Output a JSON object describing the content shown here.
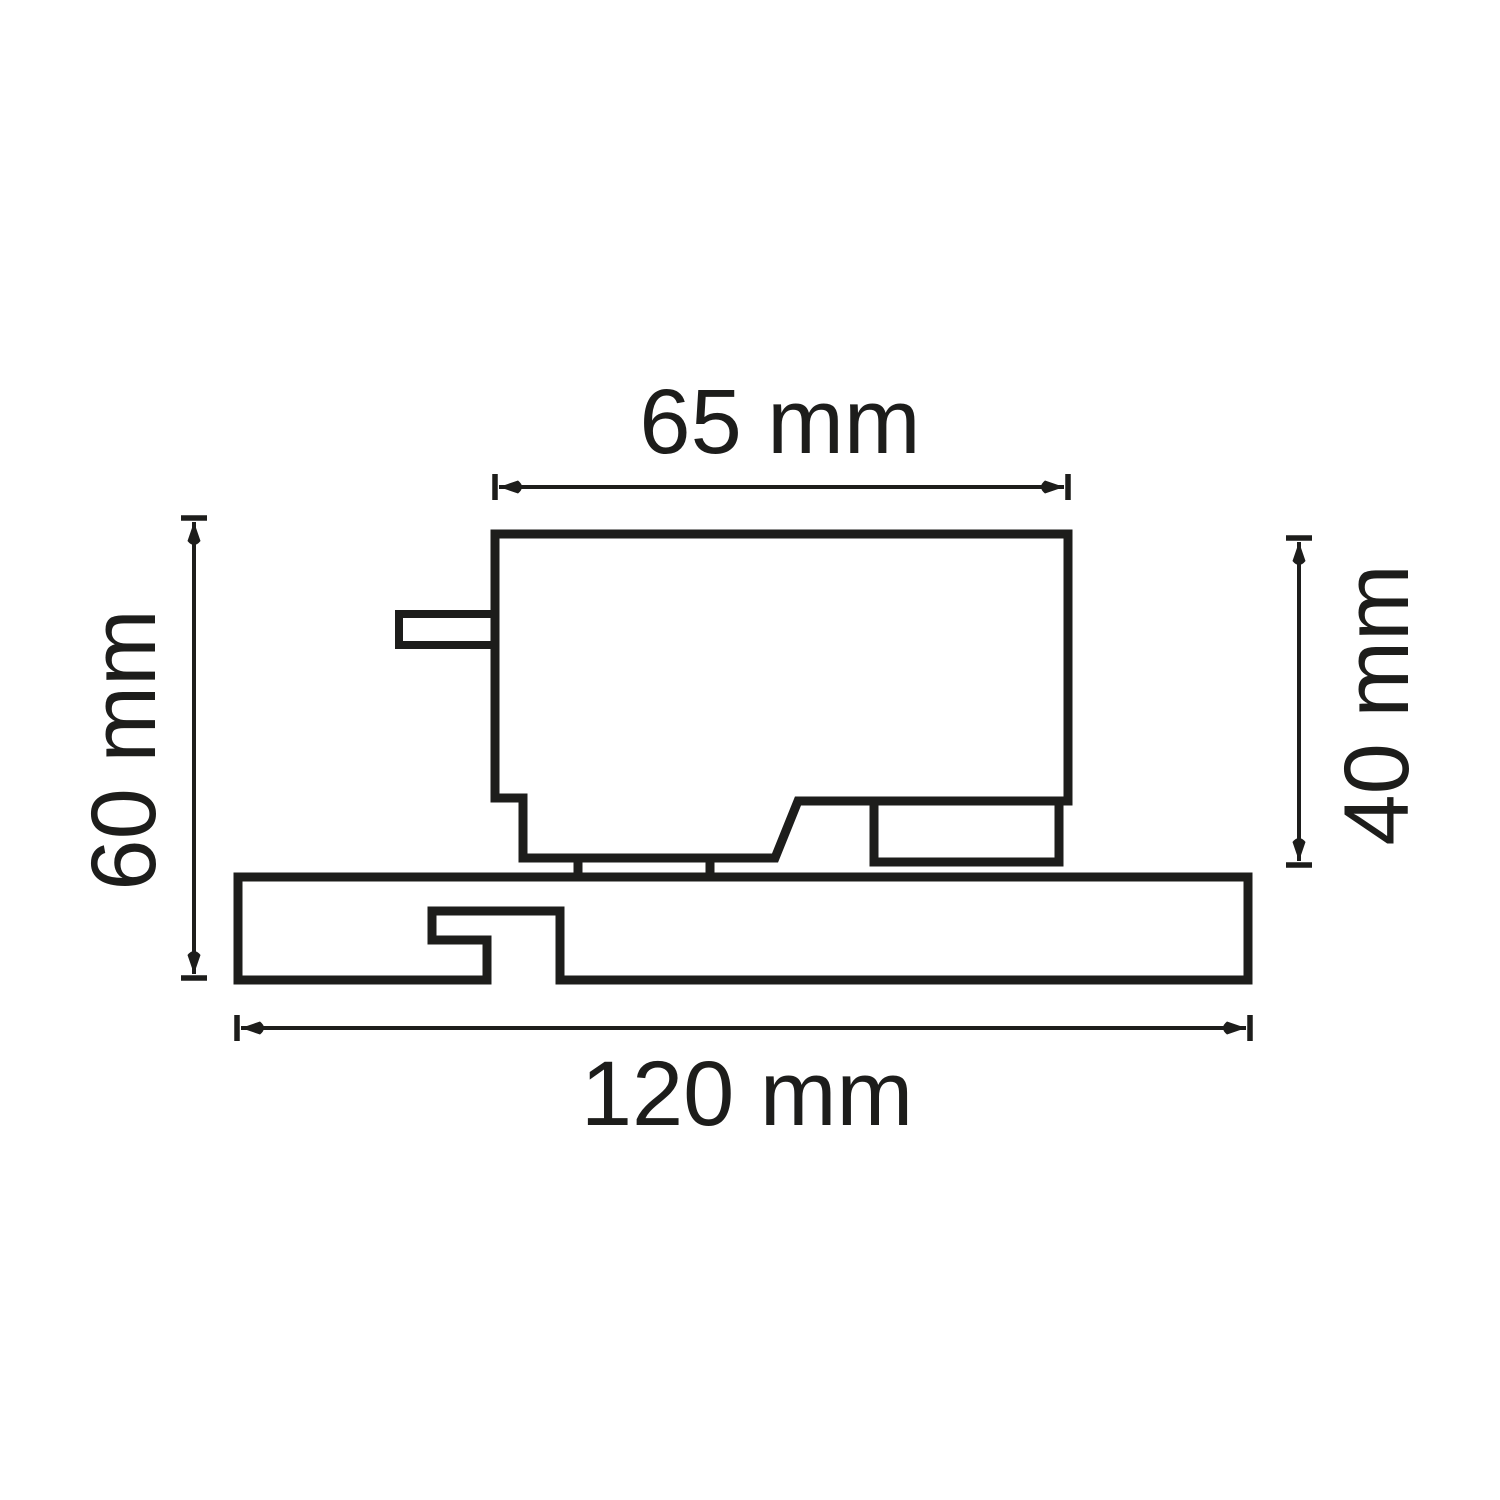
{
  "dimensions": {
    "top": {
      "label": "65 mm"
    },
    "bottom": {
      "label": "120 mm"
    },
    "left": {
      "label": "60 mm"
    },
    "right": {
      "label": "40 mm"
    }
  },
  "colors": {
    "ink": "#1d1d1b",
    "background": "#ffffff"
  }
}
